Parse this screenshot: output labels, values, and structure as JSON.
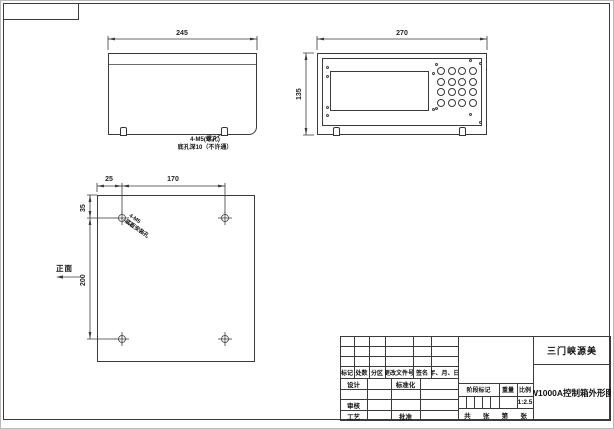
{
  "sheet": {
    "line_color": "#3a3a3a"
  },
  "side_view": {
    "dim_width": "245",
    "note_line1": "4-M5(螺孔)",
    "note_line2": "底孔深10（不许通）"
  },
  "front_view": {
    "dim_width": "270",
    "dim_height": "135",
    "keypad": {
      "rows": 4,
      "cols": 4
    }
  },
  "bottom_view": {
    "dim_edge_offset": "25",
    "dim_hole_span_h": "170",
    "dim_top_offset": "35",
    "dim_hole_span_v": "200",
    "note_line1": "4-M5",
    "note_line2": "底板安装孔",
    "front_face_label": "正面"
  },
  "title_block": {
    "company": "三门峡源美",
    "drawing_title": "W1000A控制箱外形图",
    "rev_headers": [
      "标记",
      "处数",
      "分区",
      "更改文件号",
      "签名",
      "年、月、日"
    ],
    "design_label": "设计",
    "standardization_label": "标准化",
    "check_label": "审核",
    "process_label": "工艺",
    "approve_label": "批准",
    "stage_mark_label": "阶段标记",
    "weight_label": "重量",
    "scale_label": "比例",
    "scale_value": "1:2.5",
    "sheet_total_label": "共",
    "sheet_unit1_label": "张",
    "sheet_no_label": "第",
    "sheet_unit2_label": "张"
  }
}
